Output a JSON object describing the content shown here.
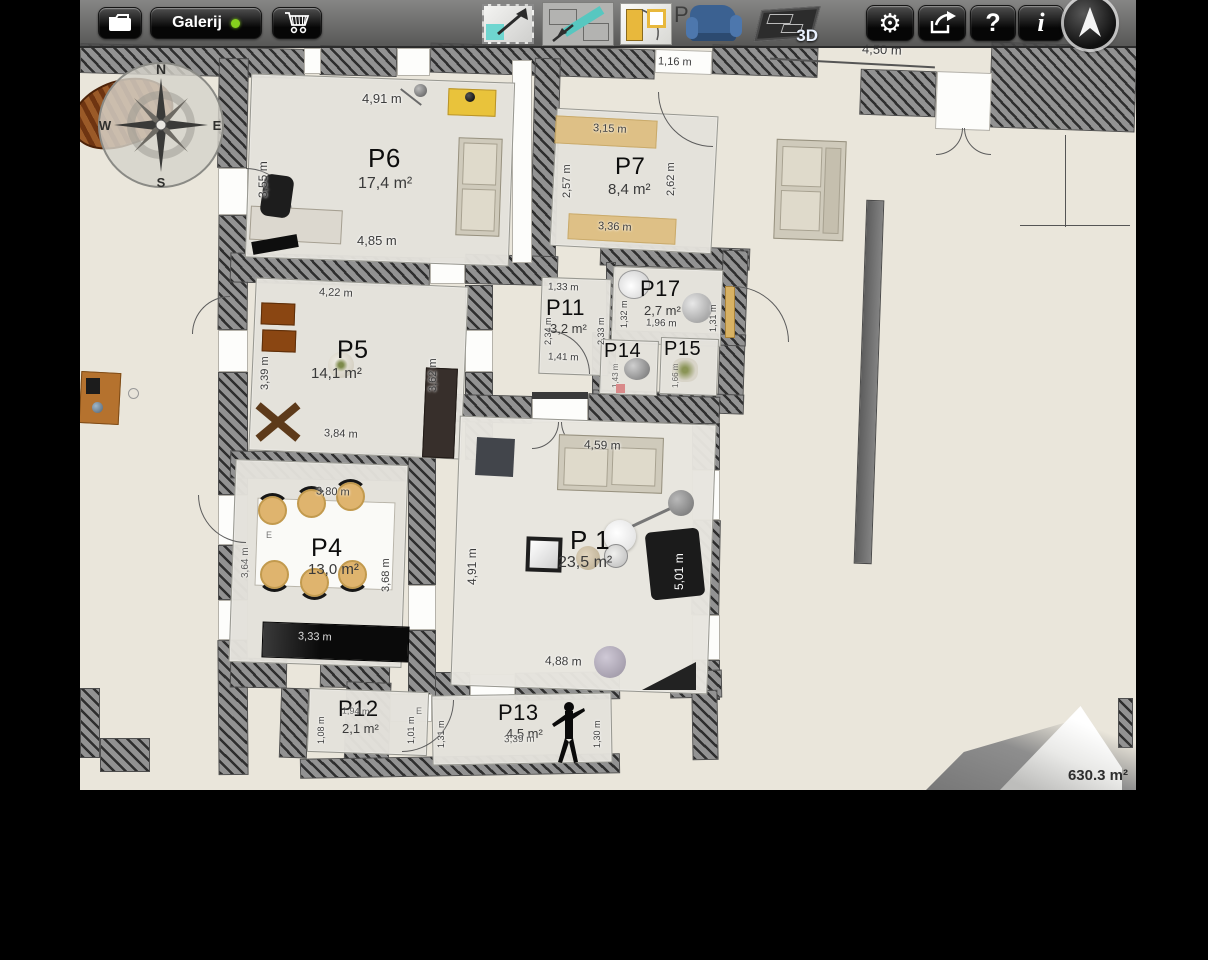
{
  "toolbar": {
    "gallery_label": "Galerij",
    "three_d_label": "3D",
    "help_label": "?",
    "info_label": "i",
    "gear_glyph": "⚙"
  },
  "compass": {
    "n": "N",
    "e": "E",
    "s": "S",
    "w": "W"
  },
  "rooms": {
    "p6": {
      "label": "P6",
      "area": "17,4 m²",
      "dim_top": "4,91 m",
      "dim_bottom": "4,85 m",
      "dim_left": "3,55 m"
    },
    "p7": {
      "label": "P7",
      "area": "8,4 m²",
      "dim_top": "3,15 m",
      "dim_bottom": "3,36 m",
      "dim_left": "2,57 m",
      "dim_right": "2,62 m",
      "dim_above": "1,16 m"
    },
    "p5": {
      "label": "P5",
      "area": "14,1 m²",
      "dim_top": "4,22 m",
      "dim_bottom": "3,84 m",
      "dim_left": "3,39 m",
      "dim_right": "3,62 m"
    },
    "p11": {
      "label": "P11",
      "area": "3,2 m²",
      "dim_top": "1,33 m",
      "dim_bottom": "1,41 m",
      "dim_left": "2,34 m",
      "dim_right": "2,33 m"
    },
    "p17": {
      "label": "P17",
      "area": "2,7 m²",
      "dim_bottom": "1,96 m",
      "dim_left": "1,32 m",
      "dim_right": "1,31 m"
    },
    "p14": {
      "label": "P14",
      "dim_a": "1,43 m"
    },
    "p15": {
      "label": "P15",
      "dim_a": "1,66 m"
    },
    "p1": {
      "label": "P 1",
      "area": "23,5 m²",
      "dim_top": "4,59 m",
      "dim_bottom": "4,88 m",
      "dim_left": "4,91 m",
      "dim_right": "5,01 m"
    },
    "p4": {
      "label": "P4",
      "area": "13,0 m²",
      "dim_top": "3,80 m",
      "dim_bottom": "3,33 m",
      "dim_left": "3,64 m",
      "dim_right": "3,68 m"
    },
    "p12": {
      "label": "P12",
      "area": "2,1 m²",
      "dim_top": "1,94 m",
      "dim_left": "1,08 m",
      "dim_right": "1,01 m"
    },
    "p13": {
      "label": "P13",
      "area": "4,5 m²",
      "dim_mid": "3,39 m",
      "dim_left": "1,31 m",
      "dim_right": "1,30 m"
    }
  },
  "misc": {
    "partial_room_label": "P",
    "dim_top_right": "4,50 m",
    "marker_e": "E"
  },
  "status": {
    "total_area": "630.3 m²"
  },
  "colors": {
    "accent_teal": "#6fd6d0",
    "gallery_dot_green": "#86d01e",
    "armchair_blue": "#3b6191",
    "band_tan": "#ddbb78"
  }
}
